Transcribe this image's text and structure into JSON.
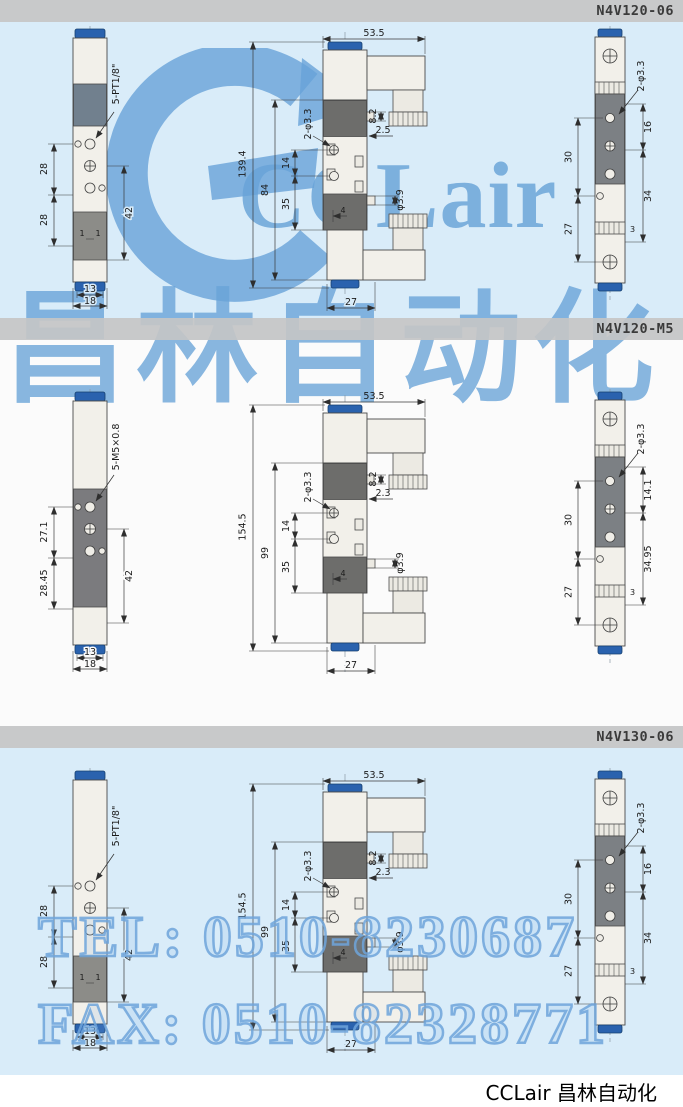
{
  "sections": [
    {
      "model": "N4V120-06",
      "left": {
        "thread_label": "5-PT1/8\"",
        "dim_a": "28",
        "dim_b": "28",
        "dim_right": "42",
        "tick_left": "1",
        "tick_right": "1",
        "width_inner": "13",
        "width_outer": "18"
      },
      "middle": {
        "width_top": "53.5",
        "height_total": "139.4",
        "height_body": "84",
        "pitch": "14",
        "dim_lower": "35",
        "holes_label": "2-φ3.3",
        "dim_step": "8.2",
        "dim_offset": "2.5",
        "port_dia": "φ3.9",
        "dim_center": "4",
        "width_bottom": "27"
      },
      "right": {
        "holes_label": "2-φ3.3",
        "left_upper": "30",
        "left_lower": "27",
        "right_upper": "16",
        "right_lower": "34",
        "dim_notch": "3"
      }
    },
    {
      "model": "N4V120-M5",
      "left": {
        "thread_label": "5-M5×0.8",
        "dim_a": "27.1",
        "dim_b": "28.45",
        "dim_right": "42",
        "width_inner": "13",
        "width_outer": "18"
      },
      "middle": {
        "width_top": "53.5",
        "height_total": "154.5",
        "height_body": "99",
        "pitch": "14",
        "dim_lower": "35",
        "holes_label": "2-φ3.3",
        "dim_step": "8.2",
        "dim_offset": "2.3",
        "port_dia": "φ3.9",
        "dim_center": "4",
        "width_bottom": "27"
      },
      "right": {
        "holes_label": "2-φ3.3",
        "left_upper": "30",
        "left_lower": "27",
        "right_upper": "14.1",
        "right_lower": "34.95",
        "dim_notch": "3"
      }
    },
    {
      "model": "N4V130-06",
      "left": {
        "thread_label": "5-PT1/8\"",
        "dim_a": "28",
        "dim_b": "28",
        "dim_right": "42",
        "tick_left": "1",
        "tick_right": "1",
        "width_inner": "13",
        "width_outer": "18"
      },
      "middle": {
        "width_top": "53.5",
        "height_total": "154.5",
        "height_body": "99",
        "pitch": "14",
        "dim_lower": "35",
        "holes_label": "2-φ3.3",
        "dim_step": "8.2",
        "dim_offset": "2.3",
        "port_dia": "φ3.9",
        "dim_center": "4",
        "width_bottom": "27"
      },
      "right": {
        "holes_label": "2-φ3.3",
        "left_upper": "30",
        "left_lower": "27",
        "right_upper": "16",
        "right_lower": "34",
        "dim_notch": "3"
      }
    }
  ],
  "watermark": {
    "logo_text": "CCLair",
    "brand_cn": "昌林自动化",
    "tel": "TEL: 0510-8230687",
    "fax": "FAX: 0510-82328771"
  },
  "footer": {
    "brand": "CCLair 昌林自动化"
  },
  "colors": {
    "section_blue": "#d9ecf9",
    "bar_gray": "#c3c4c5",
    "cap_blue": "#2a62ae",
    "watermark_blue": "#68a3d8"
  }
}
